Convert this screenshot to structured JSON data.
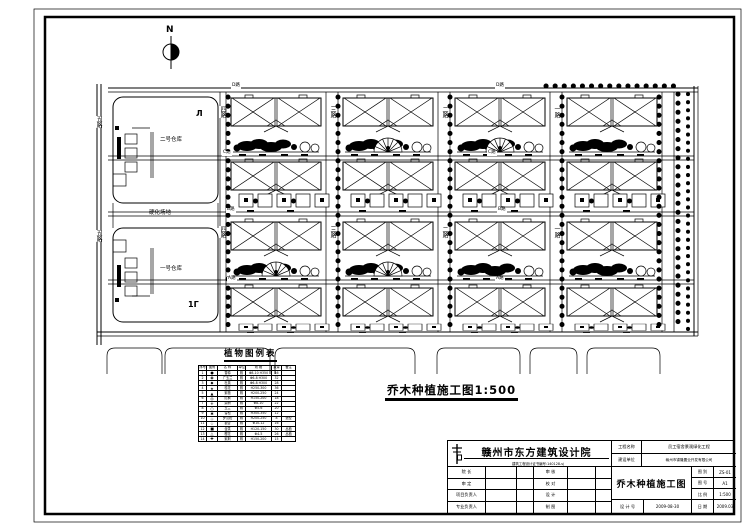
{
  "north": {
    "label": "N"
  },
  "site": {
    "outer_road": "五路",
    "v_roads": [
      "四路",
      "三路",
      "二路",
      "一路"
    ],
    "h_roads": [
      "D路",
      "C路",
      "B路",
      "A路"
    ],
    "block2": "二号仓库",
    "block1": "一号仓库",
    "middle": "硬化场地",
    "mark_top": "Л",
    "mark_bottom": "1Γ"
  },
  "caption": {
    "text": "乔木种植施工图1:500"
  },
  "legend": {
    "title": "植物图例表",
    "headers": [
      "序号",
      "图例",
      "名 称",
      "单位",
      "规 格",
      "数量",
      "备注"
    ],
    "rows": [
      [
        "1",
        "●",
        "香樟",
        "株",
        "Φ8-10 H350",
        "46",
        ""
      ],
      [
        "2",
        "◉",
        "广玉兰",
        "株",
        "Φ6-8 H300",
        "32",
        ""
      ],
      [
        "3",
        "◆",
        "杜英",
        "株",
        "Φ6-8 H300",
        "28",
        ""
      ],
      [
        "4",
        "★",
        "桂花",
        "株",
        "H250-300",
        "36",
        ""
      ],
      [
        "5",
        "▲",
        "紫薇",
        "株",
        "H200-250",
        "24",
        ""
      ],
      [
        "6",
        "◎",
        "红枫",
        "株",
        "H150-200",
        "18",
        ""
      ],
      [
        "7",
        "✳",
        "栾树",
        "株",
        "Φ8-10",
        "22",
        ""
      ],
      [
        "8",
        "○",
        "玉兰",
        "株",
        "Φ5-6",
        "20",
        ""
      ],
      [
        "9",
        "✱",
        "雪松",
        "株",
        "H300-350",
        "12",
        ""
      ],
      [
        "10",
        "◇",
        "罗汉松",
        "株",
        "H200-250",
        "8",
        "造型"
      ],
      [
        "11",
        "☆",
        "银杏",
        "株",
        "Φ10-12",
        "16",
        ""
      ],
      [
        "12",
        "■",
        "含笑",
        "株",
        "H120-150",
        "30",
        "丛植"
      ],
      [
        "13",
        "△",
        "樱花",
        "株",
        "Φ4-5",
        "26",
        "丛植"
      ],
      [
        "14",
        "✚",
        "紫荆",
        "株",
        "H150-200",
        "15",
        ""
      ]
    ]
  },
  "titleblock": {
    "company": "赣州市东方建筑设计院",
    "cert": "建筑工程设计证书编号:140128-sj",
    "sig_labels": [
      "院  长",
      "审  定",
      "项目负责人",
      "专业负责人",
      "审  核",
      "校  对",
      "设  计",
      "制  图"
    ],
    "project_label": "工程名称",
    "project_value": "员工宿舍景观绿化工程",
    "client_label": "建设单位",
    "client_value": "赣州市锦隆置业开发有限公司",
    "drawing_title": "乔木种植施工图",
    "fields": [
      {
        "label": "图 别",
        "value": "ZS-01"
      },
      {
        "label": "图 号",
        "value": "A1"
      },
      {
        "label": "比 例",
        "value": "1:500"
      }
    ],
    "design_label": "设 计 号",
    "design_value": "2009-08-30",
    "date_label": "日 期",
    "date_value": "2009.03"
  }
}
